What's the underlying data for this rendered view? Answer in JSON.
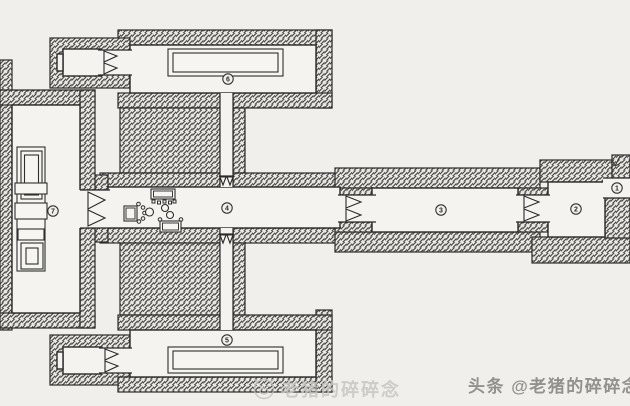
{
  "plan": {
    "drawing_kind": "hand-drawn tomb floor plan",
    "rooms": [
      {
        "name": "tunnel-passage",
        "label": "1"
      },
      {
        "name": "entrance-hall",
        "label": "2"
      },
      {
        "name": "front-hall",
        "label": "3"
      },
      {
        "name": "middle-hall",
        "label": "4"
      },
      {
        "name": "right-annex-hall",
        "label": "5"
      },
      {
        "name": "left-annex-hall",
        "label": "6"
      },
      {
        "name": "rear-hall",
        "label": "7"
      }
    ]
  },
  "watermarks": {
    "center_text": "老猪的碎碎念",
    "bottom_right_text": "头条 @老猪的碎碎念"
  },
  "icons": {
    "center_logo": "pig-avatar-icon",
    "tunnel_mark": "arrow-down-icon"
  },
  "colors": {
    "paper": "#f0efec",
    "ink": "#2a2928",
    "hatch_line": "#4a4946",
    "watermark_light": "#c8c6c1",
    "watermark_gray": "#8d8c89"
  }
}
